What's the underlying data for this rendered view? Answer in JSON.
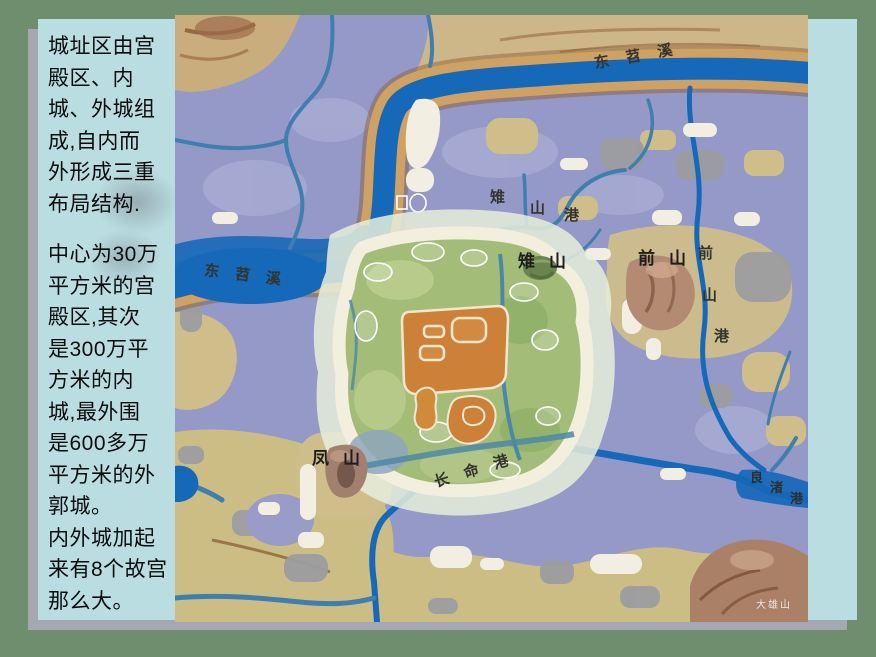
{
  "slide": {
    "background_color": "#6e8e6d",
    "panel_color": "#badde1",
    "shadow_color": "#a5a8b2"
  },
  "text_panel": {
    "paragraph1": "城址区由宫\n殿区、内\n城、外城组\n成,自内而\n外形成三重\n布局结构.",
    "paragraph2": "中心为30万\n平方米的宫\n殿区,其次\n是300万平\n方米的内\n城,最外围\n是600多万\n平方米的外\n郭城。\n内外城加起\n来有8个故宫\n那么大。"
  },
  "map": {
    "colors": {
      "river_blue": "#1668b8",
      "lowland_purple": "#9599c7",
      "highland_tan": "#d2c48e",
      "city_green": "#a3bd78",
      "wall_cream": "#f3efde",
      "palace_orange": "#cd8038",
      "hill_brown": "#ab8166"
    },
    "labels": {
      "river_top": "东苕溪",
      "river_left": "东苕溪",
      "zhishan": "雉山",
      "qianshan": "前山",
      "fengshan": "凤山",
      "changminggang": "长命港",
      "daxiongshan": "大雄山",
      "qianshangang_chars": [
        "前",
        "山",
        "港"
      ],
      "zhishangang_chars": [
        "雉",
        "山",
        "港"
      ],
      "liangzhugang_chars": [
        "良",
        "渚",
        "港"
      ]
    }
  }
}
